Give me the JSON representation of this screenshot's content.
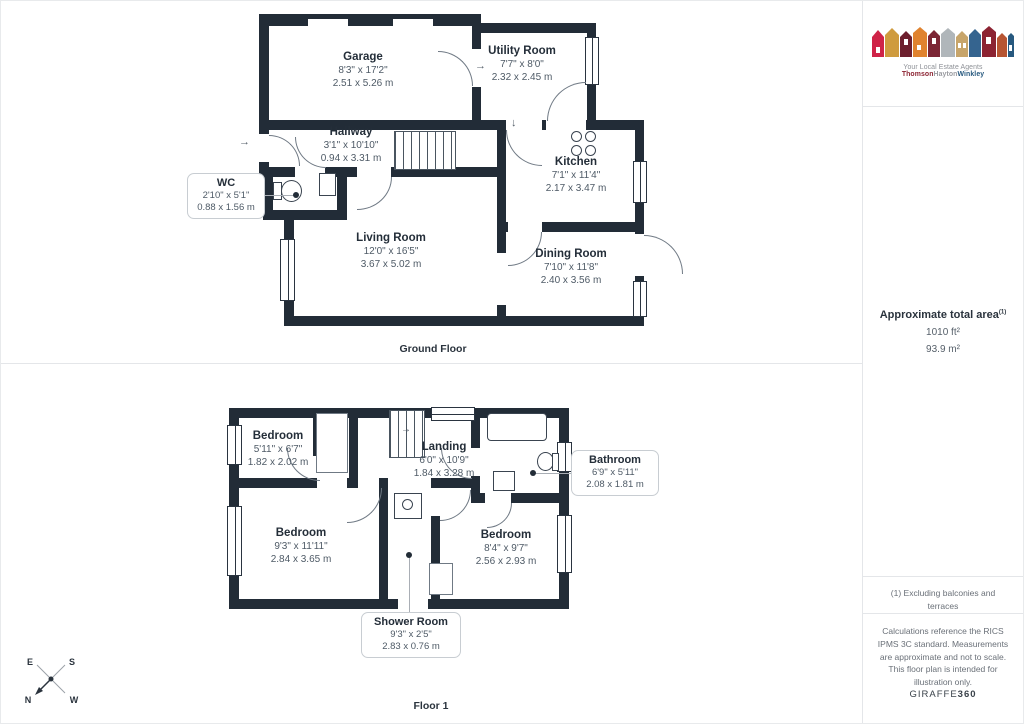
{
  "branding": {
    "tagline": "Your Local Estate Agents",
    "agency_name": {
      "part1": "Thomson",
      "part2": "Hayton",
      "part3": "Winkley"
    },
    "giraffe": {
      "brand": "GIRAFFE",
      "suffix": "360"
    }
  },
  "sidebar": {
    "area": {
      "title": "Approximate total area",
      "ref": "(1)",
      "imperial": "1010 ft²",
      "metric": "93.9 m²"
    },
    "footnote": "(1) Excluding balconies and terraces",
    "disclaimer": "Calculations reference the RICS IPMS 3C standard. Measurements are approximate and not to scale. This floor plan is intended for illustration only."
  },
  "floors": [
    {
      "label": "Ground Floor",
      "rooms": [
        {
          "name": "Garage",
          "imperial": "8'3\" x 17'2\"",
          "metric": "2.51 x 5.26 m"
        },
        {
          "name": "Utility Room",
          "imperial": "7'7\" x 8'0\"",
          "metric": "2.32 x 2.45 m"
        },
        {
          "name": "Hallway",
          "imperial": "3'1\" x 10'10\"",
          "metric": "0.94 x 3.31 m"
        },
        {
          "name": "WC",
          "imperial": "2'10\" x 5'1\"",
          "metric": "0.88 x 1.56 m"
        },
        {
          "name": "Kitchen",
          "imperial": "7'1\" x 11'4\"",
          "metric": "2.17 x 3.47 m"
        },
        {
          "name": "Living Room",
          "imperial": "12'0\" x 16'5\"",
          "metric": "3.67 x 5.02 m"
        },
        {
          "name": "Dining Room",
          "imperial": "7'10\" x 11'8\"",
          "metric": "2.40 x 3.56 m"
        }
      ]
    },
    {
      "label": "Floor 1",
      "rooms": [
        {
          "name": "Bedroom",
          "imperial": "5'11\" x 6'7\"",
          "metric": "1.82 x 2.02 m"
        },
        {
          "name": "Landing",
          "imperial": "6'0\" x 10'9\"",
          "metric": "1.84 x 3.28 m"
        },
        {
          "name": "Bathroom",
          "imperial": "6'9\" x 5'11\"",
          "metric": "2.08 x 1.81 m"
        },
        {
          "name": "Bedroom",
          "imperial": "9'3\" x 11'11\"",
          "metric": "2.84 x 3.65 m"
        },
        {
          "name": "Bedroom",
          "imperial": "8'4\" x 9'7\"",
          "metric": "2.56 x 2.93 m"
        },
        {
          "name": "Shower Room",
          "imperial": "9'3\" x 2'5\"",
          "metric": "2.83 x 0.76 m"
        }
      ]
    }
  ],
  "compass": {
    "top_left": "E",
    "top_right": "S",
    "bottom_left": "N",
    "bottom_right": "W"
  },
  "icons": {
    "door_arrow_right": "→",
    "door_arrow_down": "↓"
  },
  "colors": {
    "wall": "#222c37",
    "room_name": "#242e39",
    "dims": "#4e5a66",
    "callout_border": "#c8cdd2",
    "divider": "#e4e6e9",
    "brand_maroon": "#8c2332",
    "brand_gray": "#9a9ba0",
    "brand_blue": "#27597f"
  }
}
